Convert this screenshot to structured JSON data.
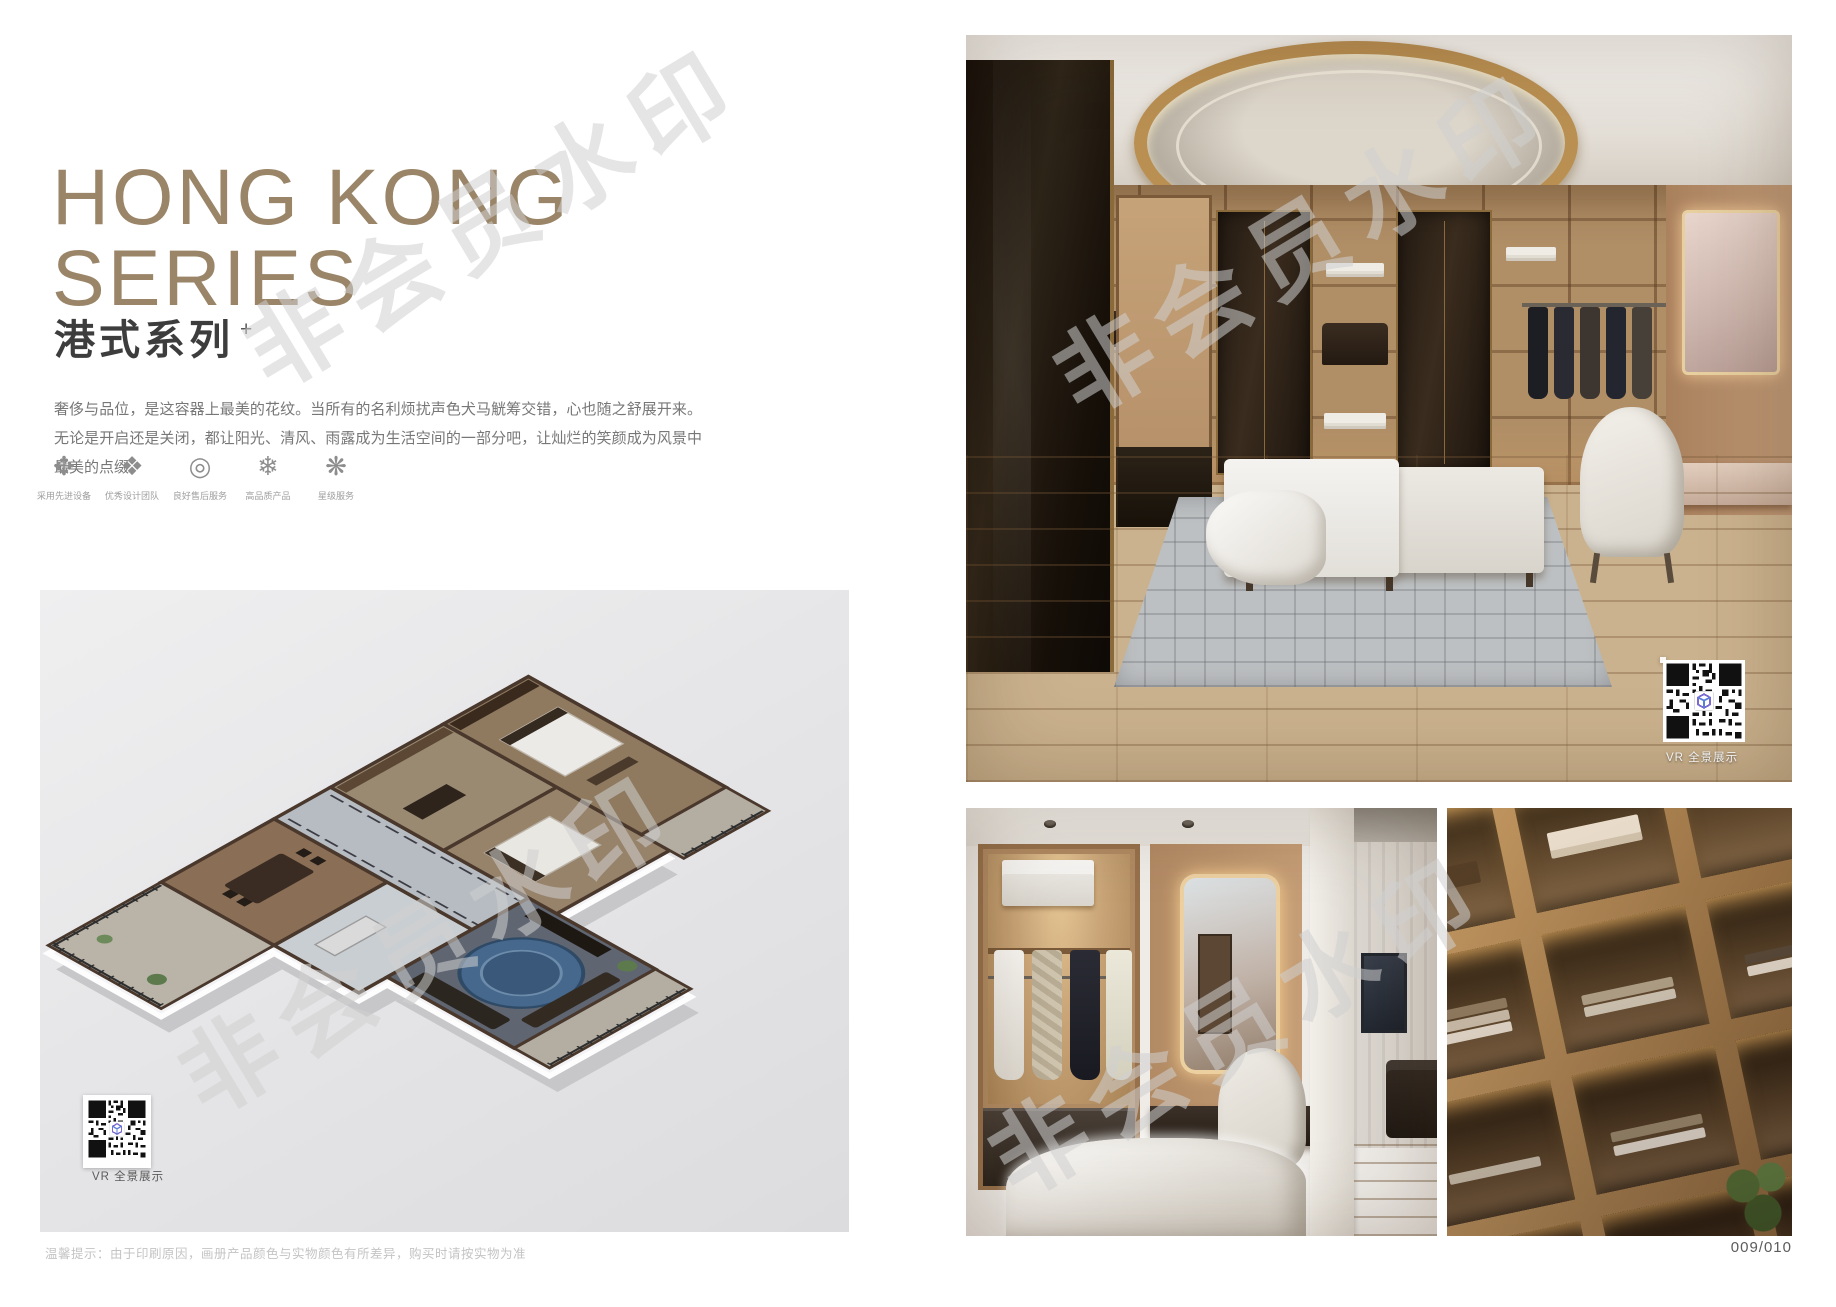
{
  "page": {
    "page_number": "009/010",
    "footer_note": "温馨提示：由于印刷原因，画册产品颜色与实物颜色有所差异，购买时请按实物为准"
  },
  "header": {
    "title_line1": "HONG KONG",
    "title_line2": "SERIES",
    "subtitle": "港式系列",
    "subtitle_superscript": "+",
    "description": "奢侈与品位，是这容器上最美的花纹。当所有的名利烦扰声色犬马觥筹交错，心也随之舒展开来。无论是开启还是关闭，都让阳光、清风、雨露成为生活空间的一部分吧，让灿烂的笑颜成为风景中最美的点缀。",
    "title_color": "#9a8568"
  },
  "features": [
    {
      "glyph": "✥",
      "label": "采用先进设备"
    },
    {
      "glyph": "❖",
      "label": "优秀设计团队"
    },
    {
      "glyph": "◎",
      "label": "良好售后服务"
    },
    {
      "glyph": "❄",
      "label": "高品质产品"
    },
    {
      "glyph": "❋",
      "label": "星级服务"
    }
  ],
  "floor_plan": {
    "vr_label": "VR 全景展示"
  },
  "main_photo": {
    "vr_label": "VR 全景展示"
  },
  "watermark": {
    "text": "非会员水印"
  },
  "colors": {
    "accent_gold": "#9a8568",
    "panel_gray": "#e4e4e6",
    "qr_logo_blue": "#5a7fd8"
  }
}
